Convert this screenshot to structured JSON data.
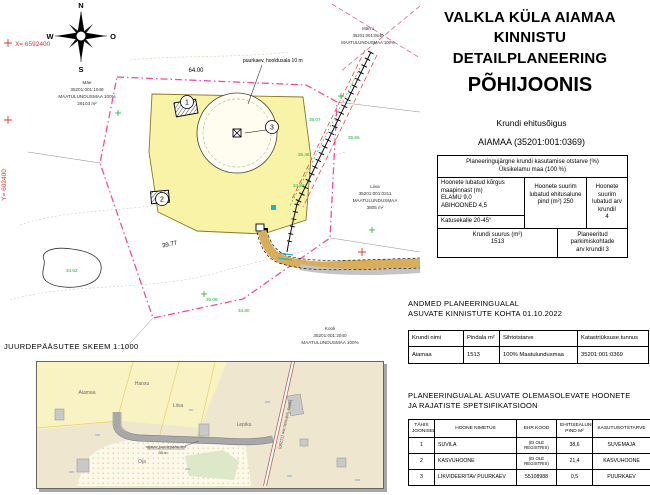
{
  "title": {
    "line1": "VALKLA KÜLA AIAMAA KINNISTU",
    "line2": "DETAILPLANEERING",
    "line3": "PÕHIJOONIS"
  },
  "krundi_ehitusoigus": {
    "heading": "Krundi ehitusõigus",
    "subheading": "AIAMAA (35201:001:0369)",
    "otstarve_l1": "Planeeringujärgne krundi kasutamise otstarve (%)",
    "otstarve_l2": "Üksikelamu maa (100 %)",
    "korgus_l1": "Hoonete lubatud kõrgus",
    "korgus_l2": "maapinnast (m)",
    "korgus_l3": "ELAMU 9,0",
    "korgus_l4": "ABIHOONED 4,5",
    "katusekalle": "Katusekalle    20-45°",
    "pind_l1": "Hoonete suurim",
    "pind_l2": "lubatud ehitusalune",
    "pind_l3": "pind (m²)    250",
    "arv_l1": "Hoonete suurim",
    "arv_l2": "lubatud arv krundil",
    "arv_l3": "4",
    "suurus_l1": "Krundi suurus (m²)",
    "suurus_l2": "1513",
    "parkimine_l1": "Planeeritud parkimiskohtade",
    "parkimine_l2": "arv krundil    3"
  },
  "andmed": {
    "title_l1": "ANDMED PLANEERINGUALAL",
    "title_l2": "ASUVATE KINNISTUTE KOHTA 01.10.2022",
    "headers": [
      "Krundi nimi",
      "Pindala m²",
      "Sihtotstarve",
      "Katastriüksuse tunnus"
    ],
    "row": {
      "nimi": "Aiamaa",
      "pindala": "1513",
      "sihtotstarve": "100% Maatulundusmaa",
      "tunnus": "35201:001:0369"
    }
  },
  "spets": {
    "title_l1": "PLANEERINGUALAL ASUVATE  OLEMASOLEVATE HOONETE",
    "title_l2": "JA RAJATISTE SPETSIFIKATSIOON",
    "headers": [
      "TÄHIS JOONISEL",
      "HOONE NIMETUS",
      "EHR KOOD",
      "EHITISEALUNE PIND  M²",
      "KASUTUSOTSTARVE"
    ],
    "rows": [
      {
        "nr": "1",
        "name": "SUVILA",
        "ehr": "(EI OLE REGISTRIS)",
        "pind": "38,6",
        "otstarve": "SUVEMAJA"
      },
      {
        "nr": "2",
        "name": "KASVUHOONE",
        "ehr": "(EI OLE REGISTRIS)",
        "pind": "21,4",
        "otstarve": "KASVUHOONE"
      },
      {
        "nr": "3",
        "name": "LIKVIDEERITAV PUURKAEV",
        "ehr": "55108988",
        "pind": "0,5",
        "otstarve": "PUURKAEV"
      }
    ]
  },
  "map": {
    "compass": {
      "n": "N",
      "e": "O",
      "s": "S",
      "w": "W"
    },
    "coord_x": "X= 6592400",
    "coord_y": "Y= 602400",
    "well_note": "puurkaev, hooldusala 10 m",
    "pos1": "1",
    "pos2": "2",
    "pos3": "3",
    "dim_top": "64.00",
    "dim_side": "39.77",
    "elev": [
      "35.07",
      "35.48",
      "34.93",
      "35.08",
      "34.80",
      "34.62",
      "35.65"
    ],
    "parcel_left": {
      "name": "Mäe",
      "code": "35201:001:1048",
      "use": "MAATULUNDUSMAA 100%",
      "area": "29103 m²"
    },
    "parcel_right": {
      "name": "Liiva",
      "code": "35201:001:0211",
      "use": "MAATULUNDUSMAA",
      "area": "3805 m²"
    },
    "parcel_topright": {
      "name": "Männi",
      "code": "35201:001:0540",
      "use": "MAATULUNDUSMAA 100%"
    },
    "parcel_bottom": {
      "name": "Kooli",
      "code": "35201:001:2040",
      "use": "MAATULUNDUSMAA 100%"
    }
  },
  "inset": {
    "title": "JUURDEPÄÄSUTEE SKEEM 1:1000",
    "labels": {
      "aiamaa": "Aiamaa",
      "hansu": "Hansu",
      "liiva": "Liiva",
      "lepiku": "Lepiku",
      "oja": "Oja"
    },
    "road_note_l1": "rajatav juurdepääsutee",
    "road_note_l2": "30 m",
    "highway": "Valkla-Salmistu tee (11280)"
  },
  "colors": {
    "boundary_pink": "#ef4e99",
    "plot_yellow": "#f8f3a6",
    "road_ochre": "#d8ae5a",
    "coord_red": "#e03535",
    "survey_green": "#1faa3c",
    "water_cyan": "#18b7cf",
    "inset_parcel": "#f9f2c2",
    "inset_bg": "#efe6d0"
  }
}
